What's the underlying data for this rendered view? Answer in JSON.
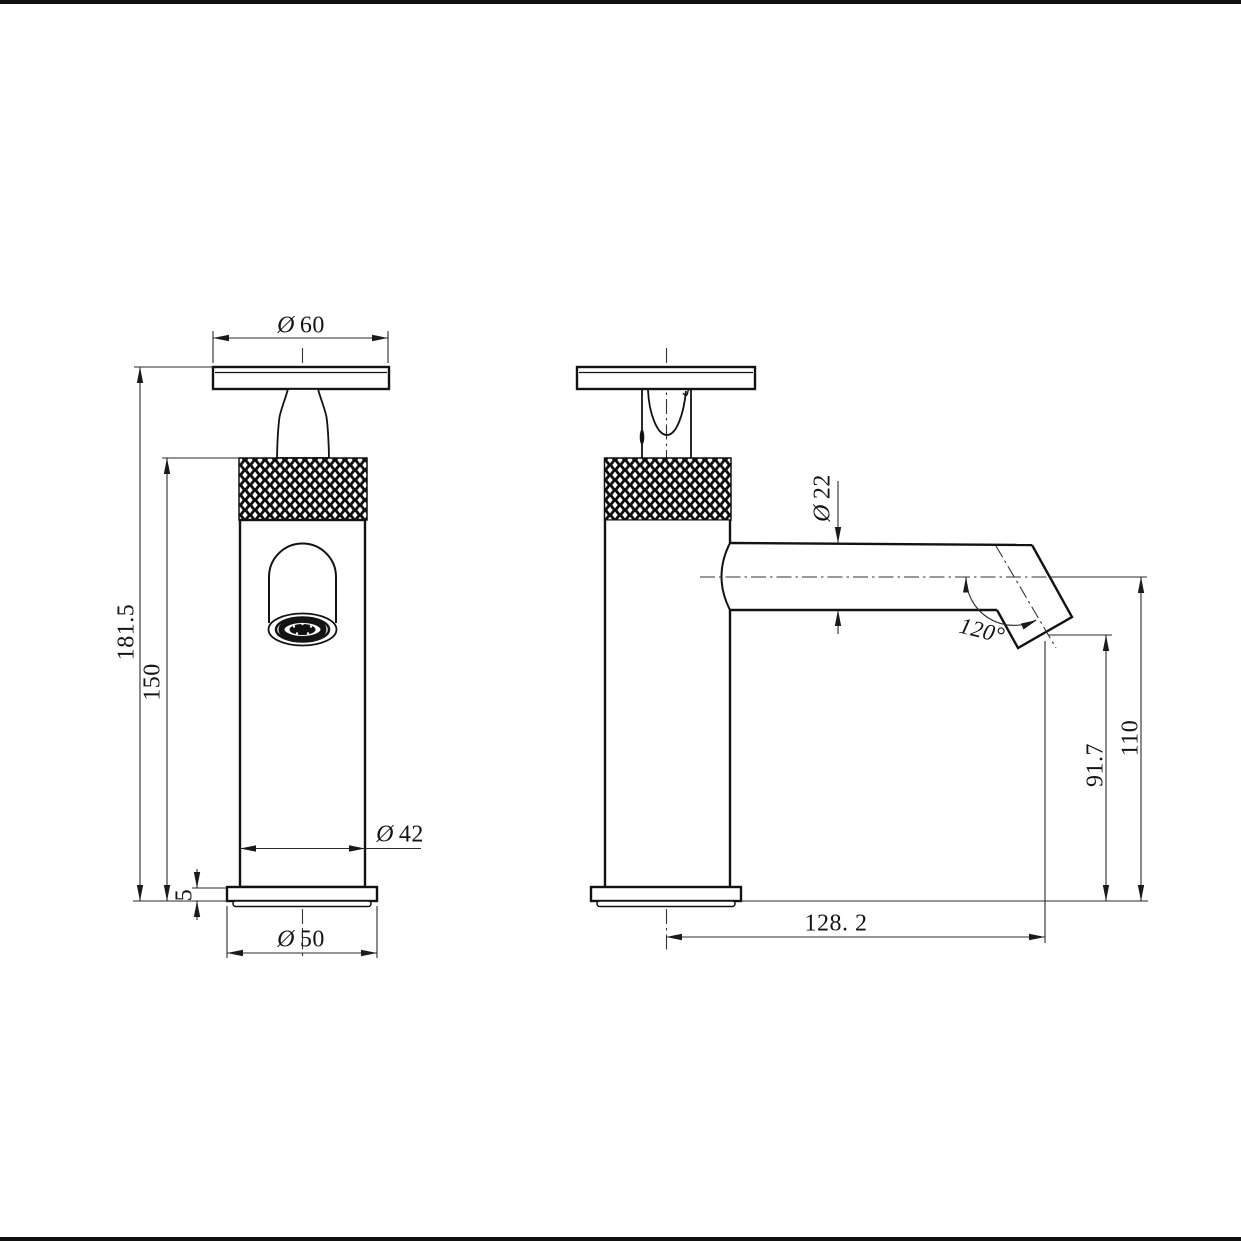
{
  "front_view": {
    "dim_handle_diameter": {
      "symbol": "Ø",
      "value": "60"
    },
    "dim_overall_height": {
      "value": "181.5"
    },
    "dim_upper_height": {
      "value": "150"
    },
    "dim_body_diameter": {
      "symbol": "Ø",
      "value": "42"
    },
    "dim_base_thickness": {
      "value": "5"
    },
    "dim_base_diameter": {
      "symbol": "Ø",
      "value": "50"
    }
  },
  "side_view": {
    "dim_spout_diameter": {
      "symbol": "Ø",
      "value": "22"
    },
    "dim_spout_angle": {
      "value": "120°"
    },
    "dim_outlet_height": {
      "value": "91.7"
    },
    "dim_axis_height": {
      "value": "110"
    },
    "dim_spout_reach": {
      "value": "128. 2"
    }
  }
}
